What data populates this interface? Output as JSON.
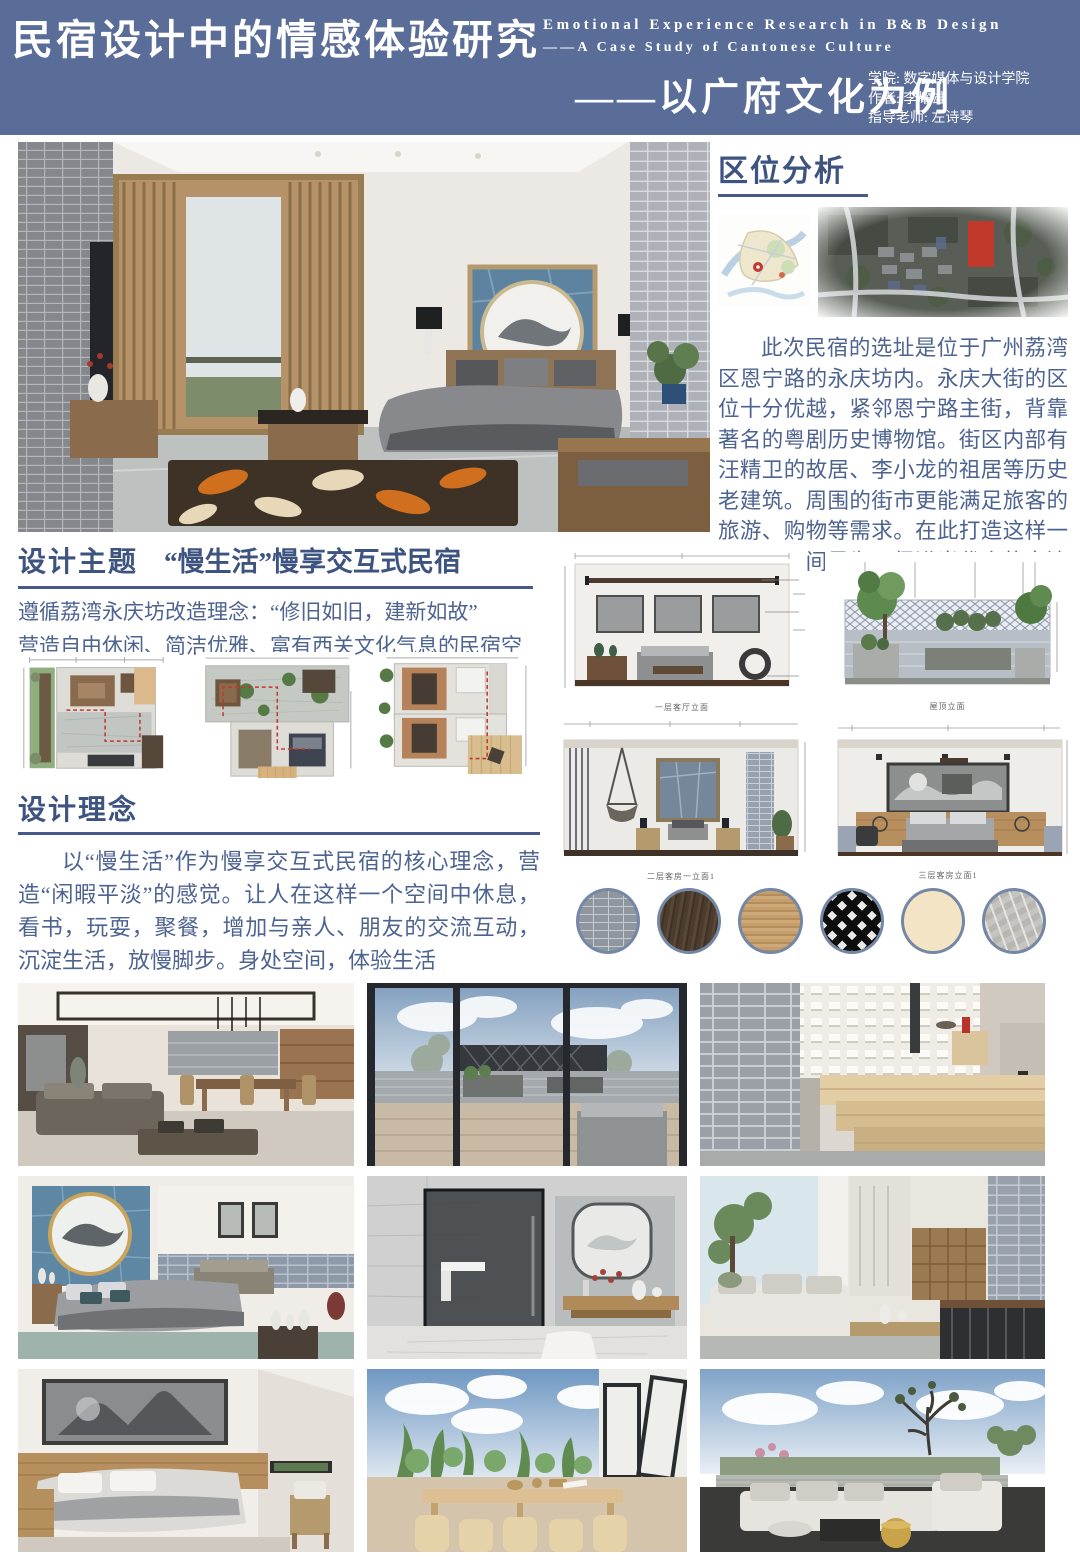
{
  "colors": {
    "header_bg": "#5a6d99",
    "heading": "#3d5380",
    "body_text": "#4d6391",
    "rule": "#46598a",
    "swatch_ring": "#7487a5",
    "plan_route_red": "#c0392b"
  },
  "header": {
    "title_cn": "民宿设计中的情感体验研究",
    "subtitle_cn": "——以广府文化为例",
    "title_en_line1": "Emotional Experience Research in B&B Design",
    "title_en_line2": "——A Case Study of Cantonese Culture",
    "credits": [
      {
        "label": "学院:",
        "value": "数字媒体与设计学院"
      },
      {
        "label": "作者:",
        "value": "李耀雄"
      },
      {
        "label": "指导老师:",
        "value": "左诗琴"
      }
    ]
  },
  "location": {
    "heading": "区位分析",
    "body": "此次民宿的选址是位于广州荔湾区恩宁路的永庆坊内。永庆大街的区位十分优越，紧邻恩宁路主街，背靠著名的粤剧历史博物馆。街区内部有汪精卫的故居、李小龙的祖居等历史老建筑。周围的街市更能满足旅客的旅游、购物等需求。在此打造这样一个民宿空间是为了促进当代人的交流互动，"
  },
  "theme": {
    "heading": "设计主题",
    "heading_sub": "“慢生活”慢享交互式民宿",
    "line1": "遵循荔湾永庆坊改造理念：“修旧如旧，建新如故”",
    "line2": "营造自由休闲、简洁优雅、富有西关文化气息的民宿空间"
  },
  "concept": {
    "heading": "设计理念",
    "body": "以“慢生活”作为慢享交互式民宿的核心理念，营造“闲暇平淡”的感觉。让人在这样一个空间中休息，看书，玩耍，聚餐，增加与亲人、朋友的交流互动，沉淀生活，放慢脚步。身处空间，体验生活"
  },
  "elevations": [
    {
      "caption": "一层客厅立面"
    },
    {
      "caption": "屋顶立面"
    },
    {
      "caption": "二层客房一立面1"
    },
    {
      "caption": "三层客房立面1"
    }
  ],
  "materials": [
    {
      "name": "grey-brick",
      "base_color": "#8f969e"
    },
    {
      "name": "dark-walnut-wood",
      "base_color": "#4c3c2d"
    },
    {
      "name": "oak-wood",
      "base_color": "#c59e6e"
    },
    {
      "name": "metal-lattice",
      "base_color": "#0c0c0c"
    },
    {
      "name": "cream-paint",
      "base_color": "#f2e4c4"
    },
    {
      "name": "grey-marble",
      "base_color": "#c5c4c0"
    }
  ]
}
